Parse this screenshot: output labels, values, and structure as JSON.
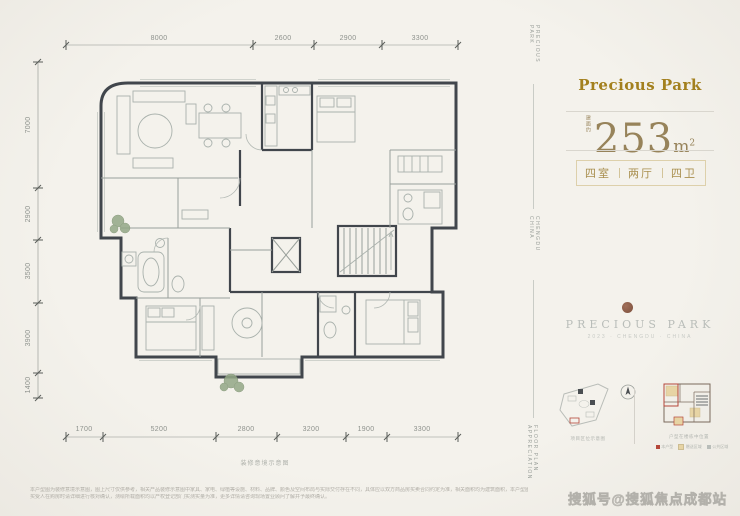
{
  "brand": {
    "wordmark": "Precious Park",
    "serif_name": "PRECIOUS PARK",
    "serif_subtitle": "2023 · CHENGDU · CHINA",
    "accent_gold": "#a3801e",
    "bronze": "#97835a",
    "logo_brown": "#8d5f48"
  },
  "area": {
    "prefix": "建面约",
    "value": "253",
    "unit": "m",
    "unit_sup": "2"
  },
  "badge": {
    "item1": "四室",
    "item2": "两厅",
    "item3": "四卫"
  },
  "rail": {
    "top": "PRECIOUS PARK",
    "middle": "CHENGDU CHINA",
    "bottom": "FLOOR PLAN APPRECIATION"
  },
  "plan": {
    "dims_top": [
      "8000",
      "2600",
      "2900",
      "3300"
    ],
    "dims_left": [
      "7000",
      "2900",
      "3500",
      "3900",
      "1400"
    ],
    "dims_bottom": [
      "1700",
      "5200",
      "2800",
      "3200",
      "1900",
      "3300"
    ],
    "caption": "装修意境示意图"
  },
  "minimap": {
    "site_caption": "项目区位示意图",
    "unit_caption": "户型在楼栋中位置",
    "north_label": "N",
    "legend": [
      {
        "label": "本户型",
        "color": "#b5473a"
      },
      {
        "label": "赠送区域",
        "color": "#e7d4a4"
      },
      {
        "label": "公共区域",
        "color": "#b9bdb9"
      }
    ]
  },
  "footer": {
    "disclaimer_line1": "本户型图为装修意境示意图，图上尺寸仅供参考，相关产品装修示意图中家具、家电、绿植等设施、材料、品牌、颜色及空间布局与实际交付存在不同，具体应以双方商品房买卖合同约定为准，相关面积均为建筑面积，本户型图仅为宣传资料，广告中对项目的介绍均为要约邀请，户型比例及交付标准以政府最终批准文件为准。",
    "disclaimer_line2": "买受人在购房时请详细进行核对确认，测绘所载面积均以产权登记部门实测实量为准，更多详情请咨询现场置业顾问了解并予最终确认。"
  },
  "watermark": "搜狐号@搜狐焦点成都站"
}
